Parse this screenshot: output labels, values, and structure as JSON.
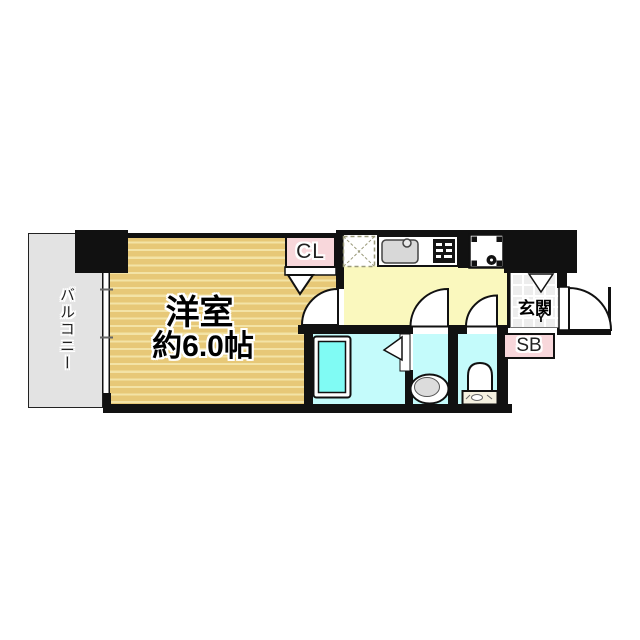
{
  "plan": {
    "type": "apartment-floor-plan",
    "balcony": {
      "label": "バルコニー"
    },
    "main_room": {
      "name": "洋室",
      "size": "約6.0帖"
    },
    "closet": {
      "label": "CL"
    },
    "entrance": {
      "label": "玄関",
      "step_mark": "Y"
    },
    "shoe_box": {
      "label": "SB"
    },
    "fixtures": [
      "refrigerator-space",
      "kitchen-sink",
      "gas-stove",
      "washing-machine-pan",
      "bathtub",
      "washbasin",
      "toilet"
    ],
    "colors": {
      "wall": "#111111",
      "room_floor": "#E7C877",
      "room_floor_stripe": "#F3E3A6",
      "kitchen_floor": "#FAF8BE",
      "wet_area_floor": "#C4FBFB",
      "bathtub": "#80FBF4",
      "closet_shoebox_pink": "#F8D7DB",
      "balcony_gray": "#E3E3E3",
      "entrance_tile": "#EDEDED"
    }
  }
}
